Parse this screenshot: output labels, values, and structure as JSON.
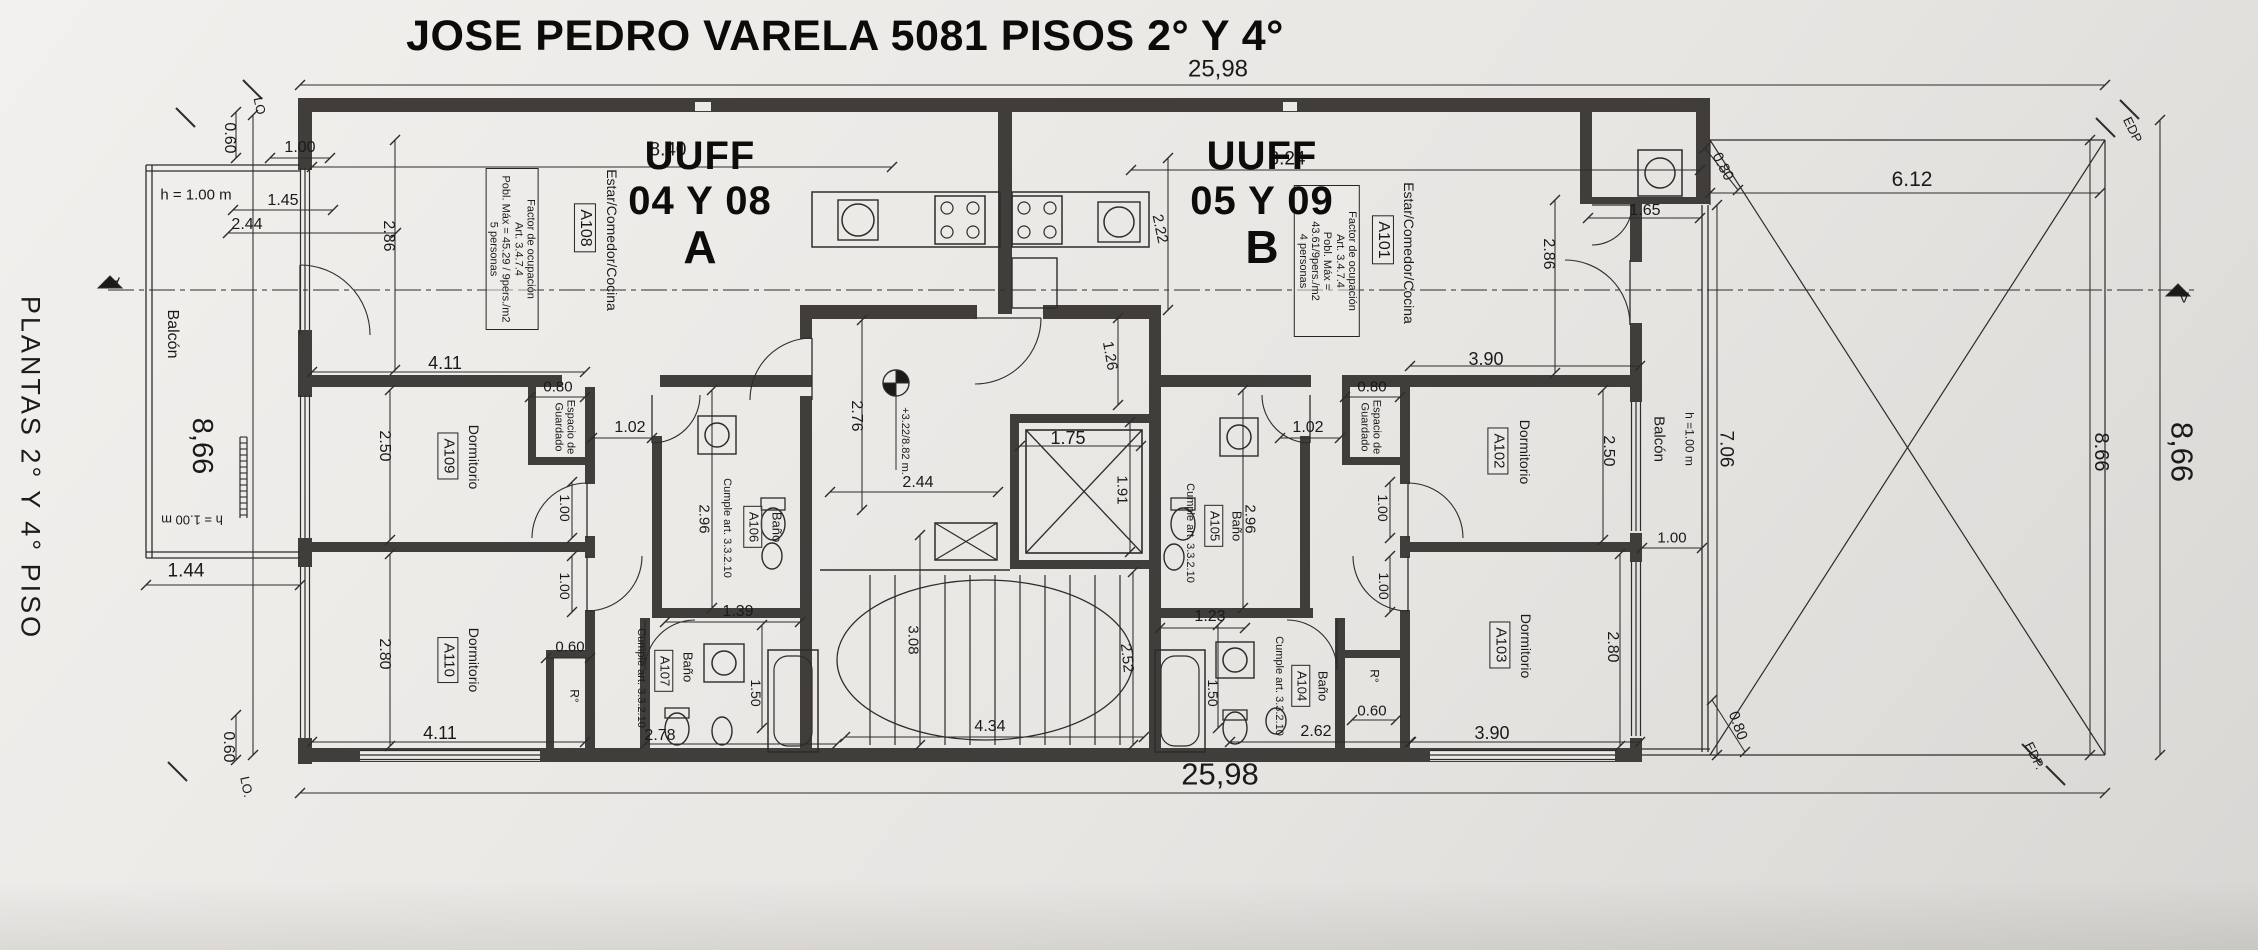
{
  "header": {
    "title": "JOSE PEDRO VARELA 5081 PISOS 2° Y 4°"
  },
  "side_label": "PLANTAS 2° Y 4° PISO",
  "units": {
    "a": {
      "uuff": "UUFF",
      "numbers": "04 Y 08",
      "letter": "A"
    },
    "b": {
      "uuff": "UUFF",
      "numbers": "05 Y 09",
      "letter": "B"
    }
  },
  "colors": {
    "paper": "#eceae7",
    "ink": "#2e2c2a",
    "wall": "#403d3b"
  },
  "labels": [
    {
      "name": "dim-frente-top",
      "text": "25,98",
      "x": 1218,
      "y": 70,
      "size": 24
    },
    {
      "name": "dim-frente-bottom",
      "text": "25,98",
      "x": 1220,
      "y": 775,
      "size": 31
    },
    {
      "name": "dim-patio-frente",
      "text": "6.12",
      "x": 1912,
      "y": 180,
      "size": 21
    },
    {
      "name": "dim-patio-lateral",
      "text": "8.66",
      "x": 2101,
      "y": 452,
      "rot": 90,
      "size": 20
    },
    {
      "name": "dim-lateral-right",
      "text": "8,66",
      "x": 2181,
      "y": 452,
      "rot": 90,
      "size": 31
    },
    {
      "name": "dim-lateral-left",
      "text": "8,66",
      "x": 202,
      "y": 446,
      "rot": 90,
      "size": 29
    },
    {
      "name": "edp-marker-top",
      "text": "EDP",
      "x": 2132,
      "y": 130,
      "rot": 64,
      "size": 13
    },
    {
      "name": "edp-marker-bottom",
      "text": "EDP.",
      "x": 2034,
      "y": 756,
      "rot": 64,
      "size": 13
    },
    {
      "name": "lot-marker-top",
      "text": "LO",
      "x": 259,
      "y": 106,
      "rot": 78,
      "size": 13
    },
    {
      "name": "lot-marker-bottom",
      "text": "LO.",
      "x": 246,
      "y": 787,
      "rot": 78,
      "size": 13
    },
    {
      "name": "balcony-a-label",
      "text": "Balcón",
      "x": 172,
      "y": 334,
      "rot": 90,
      "size": 16
    },
    {
      "name": "balcony-a-h-top",
      "text": "h = 1.00 m",
      "x": 196,
      "y": 196,
      "size": 15
    },
    {
      "name": "balcony-a-h-bottom",
      "text": "h = 1.00 m",
      "x": 192,
      "y": 519,
      "rot": 180,
      "size": 13
    },
    {
      "name": "dim-balcony-a",
      "text": "1.44",
      "x": 186,
      "y": 571,
      "size": 19
    },
    {
      "name": "dim-setback-top-left",
      "text": "0.60",
      "x": 229,
      "y": 138,
      "rot": 90,
      "size": 16
    },
    {
      "name": "dim-setback-bottom-left",
      "text": "0.60",
      "x": 228,
      "y": 747,
      "rot": 90,
      "size": 16
    },
    {
      "name": "dim-estar-a-win1",
      "text": "1.00",
      "x": 300,
      "y": 148,
      "size": 16
    },
    {
      "name": "dim-estar-a-win2",
      "text": "1.45",
      "x": 283,
      "y": 201,
      "size": 16
    },
    {
      "name": "dim-estar-a-win3",
      "text": "2.44",
      "x": 247,
      "y": 225,
      "size": 16
    },
    {
      "name": "dim-estar-a-depth",
      "text": "2.86",
      "x": 388,
      "y": 236,
      "rot": 90,
      "size": 16
    },
    {
      "name": "dim-estar-a-width",
      "text": "8.40",
      "x": 668,
      "y": 150,
      "size": 19
    },
    {
      "name": "estar-a-label",
      "text": "Estar/Comedor/Cocina",
      "x": 611,
      "y": 240,
      "rot": 90,
      "size": 14
    },
    {
      "name": "estar-a-tag",
      "text": "A108",
      "x": 585,
      "y": 228,
      "rot": 90,
      "size": 16,
      "boxed": true
    },
    {
      "name": "occupancy-note-a",
      "text": "Factor de ocupación\nArt. 3.4.7.4\nPobl. Máx = 45.29 / 9pers./m2\n5 personas",
      "x": 512,
      "y": 249,
      "rot": 90,
      "size": 11,
      "boxed": true,
      "w": 150
    },
    {
      "name": "dim-a109-width",
      "text": "4.11",
      "x": 445,
      "y": 363,
      "size": 18
    },
    {
      "name": "dim-a109-depth",
      "text": "2.50",
      "x": 384,
      "y": 446,
      "rot": 90,
      "size": 16
    },
    {
      "name": "a109-label",
      "text": "Dormitorio",
      "x": 473,
      "y": 457,
      "rot": 90,
      "size": 14
    },
    {
      "name": "a109-tag",
      "text": "A109",
      "x": 448,
      "y": 456,
      "rot": 90,
      "size": 15,
      "boxed": true
    },
    {
      "name": "dim-closet-a",
      "text": "0.80",
      "x": 558,
      "y": 388,
      "size": 15
    },
    {
      "name": "closet-a-label",
      "text": "Espacio de\nGuardado",
      "x": 564,
      "y": 427,
      "rot": 90,
      "size": 11
    },
    {
      "name": "dim-pasillo-a",
      "text": "1.02",
      "x": 630,
      "y": 428,
      "size": 16
    },
    {
      "name": "dim-door-a109",
      "text": "1.00",
      "x": 564,
      "y": 508,
      "rot": 90,
      "size": 14
    },
    {
      "name": "dim-door-a110",
      "text": "1.00",
      "x": 564,
      "y": 586,
      "rot": 90,
      "size": 14
    },
    {
      "name": "dim-bano-a106-depth",
      "text": "2.96",
      "x": 703,
      "y": 519,
      "rot": 90,
      "size": 15
    },
    {
      "name": "bano-a106-note",
      "text": "Cumple art. 3.3.2.10",
      "x": 727,
      "y": 528,
      "rot": 90,
      "size": 11
    },
    {
      "name": "bano-a106-tag",
      "text": "A106",
      "x": 753,
      "y": 527,
      "rot": 90,
      "size": 13,
      "boxed": true
    },
    {
      "name": "bano-a106-label",
      "text": "Baño",
      "x": 776,
      "y": 527,
      "rot": 90,
      "size": 13
    },
    {
      "name": "dim-bano-a106-width",
      "text": "1.39",
      "x": 738,
      "y": 612,
      "size": 16
    },
    {
      "name": "dim-ropero-a",
      "text": "0.60",
      "x": 570,
      "y": 648,
      "size": 15
    },
    {
      "name": "ropero-a-label",
      "text": "R°",
      "x": 574,
      "y": 696,
      "rot": 90,
      "size": 12
    },
    {
      "name": "a110-label",
      "text": "Dormitorio",
      "x": 473,
      "y": 660,
      "rot": 90,
      "size": 14
    },
    {
      "name": "a110-tag",
      "text": "A110",
      "x": 448,
      "y": 660,
      "rot": 90,
      "size": 15,
      "boxed": true
    },
    {
      "name": "dim-a110-depth",
      "text": "2.80",
      "x": 384,
      "y": 654,
      "rot": 90,
      "size": 16
    },
    {
      "name": "dim-a110-width",
      "text": "4.11",
      "x": 440,
      "y": 733,
      "size": 18
    },
    {
      "name": "bano-a107-note",
      "text": "Cumple art. 3.3.2.10",
      "x": 641,
      "y": 678,
      "rot": 90,
      "size": 11
    },
    {
      "name": "bano-a107-tag",
      "text": "A107",
      "x": 664,
      "y": 671,
      "rot": 90,
      "size": 13,
      "boxed": true
    },
    {
      "name": "bano-a107-label",
      "text": "Baño",
      "x": 687,
      "y": 667,
      "rot": 90,
      "size": 13
    },
    {
      "name": "dim-bano-a107-width",
      "text": "2.78",
      "x": 660,
      "y": 736,
      "size": 16
    },
    {
      "name": "dim-bano-a107-depth",
      "text": "1.50",
      "x": 755,
      "y": 693,
      "rot": 90,
      "size": 14
    },
    {
      "name": "dim-hall-depth",
      "text": "2.76",
      "x": 856,
      "y": 416,
      "rot": 90,
      "size": 16
    },
    {
      "name": "elevation-note",
      "text": "+3.22/8.82 m.",
      "x": 905,
      "y": 441,
      "rot": 90,
      "size": 11
    },
    {
      "name": "dim-hall-width",
      "text": "2.44",
      "x": 918,
      "y": 483,
      "size": 16
    },
    {
      "name": "dim-elevator-width",
      "text": "1.75",
      "x": 1068,
      "y": 438,
      "size": 18
    },
    {
      "name": "dim-elevator-depth",
      "text": "1.91",
      "x": 1121,
      "y": 490,
      "rot": 90,
      "size": 15
    },
    {
      "name": "dim-hall-front",
      "text": "1.26",
      "x": 1109,
      "y": 356,
      "rot": 80,
      "size": 15
    },
    {
      "name": "dim-cocina-b",
      "text": "2.22",
      "x": 1159,
      "y": 229,
      "rot": 78,
      "size": 15
    },
    {
      "name": "dim-stairs-width",
      "text": "3.08",
      "x": 912,
      "y": 640,
      "rot": 90,
      "size": 15
    },
    {
      "name": "dim-stairs-run",
      "text": "2.52",
      "x": 1126,
      "y": 658,
      "rot": 84,
      "size": 15
    },
    {
      "name": "dim-stairs-length",
      "text": "4.34",
      "x": 990,
      "y": 727,
      "size": 16
    },
    {
      "name": "dim-estar-b-width",
      "text": "8.24",
      "x": 1287,
      "y": 159,
      "size": 19
    },
    {
      "name": "estar-b-label",
      "text": "Estar/Comedor/Cocina",
      "x": 1408,
      "y": 253,
      "rot": 90,
      "size": 14
    },
    {
      "name": "estar-b-tag",
      "text": "A101",
      "x": 1383,
      "y": 240,
      "rot": 90,
      "size": 16,
      "boxed": true
    },
    {
      "name": "occupancy-note-b",
      "text": "Factor de ocupación\nArt. 3.4.7.4\nPobl. Máx = 43.61/9pers./m2\n4 personas",
      "x": 1327,
      "y": 261,
      "rot": 90,
      "size": 11,
      "boxed": true,
      "w": 140
    },
    {
      "name": "dim-lavadero",
      "text": "1.65",
      "x": 1645,
      "y": 211,
      "size": 16
    },
    {
      "name": "dim-estar-b-depth",
      "text": "2.86",
      "x": 1548,
      "y": 254,
      "rot": 90,
      "size": 16
    },
    {
      "name": "dim-closet-b",
      "text": "0.80",
      "x": 1372,
      "y": 388,
      "size": 15
    },
    {
      "name": "closet-b-label",
      "text": "Espacio de\nGuardado",
      "x": 1370,
      "y": 427,
      "rot": 90,
      "size": 11
    },
    {
      "name": "dim-pasillo-b",
      "text": "1.02",
      "x": 1308,
      "y": 428,
      "size": 16
    },
    {
      "name": "dim-bano-a105-depth",
      "text": "2.96",
      "x": 1249,
      "y": 519,
      "rot": 90,
      "size": 15
    },
    {
      "name": "bano-a105-note",
      "text": "Cumple art. 3.3.2.10",
      "x": 1190,
      "y": 533,
      "rot": 90,
      "size": 11
    },
    {
      "name": "bano-a105-tag",
      "text": "A105",
      "x": 1214,
      "y": 526,
      "rot": 90,
      "size": 13,
      "boxed": true
    },
    {
      "name": "bano-a105-label",
      "text": "Baño",
      "x": 1236,
      "y": 526,
      "rot": 90,
      "size": 13
    },
    {
      "name": "dim-bano-a105-width",
      "text": "1.23",
      "x": 1210,
      "y": 617,
      "size": 16
    },
    {
      "name": "dim-door-a102",
      "text": "1.00",
      "x": 1382,
      "y": 508,
      "rot": 90,
      "size": 14
    },
    {
      "name": "dim-door-a103",
      "text": "1.00",
      "x": 1383,
      "y": 586,
      "rot": 90,
      "size": 14
    },
    {
      "name": "dim-a102-width",
      "text": "3.90",
      "x": 1486,
      "y": 359,
      "size": 18
    },
    {
      "name": "a102-label",
      "text": "Dormitorio",
      "x": 1524,
      "y": 452,
      "rot": 90,
      "size": 14
    },
    {
      "name": "a102-tag",
      "text": "A102",
      "x": 1498,
      "y": 451,
      "rot": 90,
      "size": 15,
      "boxed": true
    },
    {
      "name": "dim-a102-depth",
      "text": "2.50",
      "x": 1608,
      "y": 451,
      "rot": 90,
      "size": 16
    },
    {
      "name": "a103-label",
      "text": "Dormitorio",
      "x": 1525,
      "y": 646,
      "rot": 90,
      "size": 14
    },
    {
      "name": "a103-tag",
      "text": "A103",
      "x": 1500,
      "y": 645,
      "rot": 90,
      "size": 15,
      "boxed": true
    },
    {
      "name": "dim-a103-depth",
      "text": "2.80",
      "x": 1612,
      "y": 647,
      "rot": 90,
      "size": 16
    },
    {
      "name": "dim-a103-width",
      "text": "3.90",
      "x": 1492,
      "y": 733,
      "size": 18
    },
    {
      "name": "bano-a104-note",
      "text": "Cumple art. 3.3.2.10",
      "x": 1279,
      "y": 686,
      "rot": 90,
      "size": 11
    },
    {
      "name": "bano-a104-tag",
      "text": "A104",
      "x": 1301,
      "y": 686,
      "rot": 90,
      "size": 13,
      "boxed": true
    },
    {
      "name": "bano-a104-label",
      "text": "Baño",
      "x": 1322,
      "y": 686,
      "rot": 90,
      "size": 13
    },
    {
      "name": "dim-bano-a104-width",
      "text": "2.62",
      "x": 1316,
      "y": 732,
      "size": 16
    },
    {
      "name": "dim-bano-a104-depth",
      "text": "1.50",
      "x": 1212,
      "y": 693,
      "rot": 90,
      "size": 14
    },
    {
      "name": "ropero-b-label",
      "text": "R°",
      "x": 1374,
      "y": 676,
      "rot": 90,
      "size": 12
    },
    {
      "name": "dim-ropero-b",
      "text": "0.60",
      "x": 1372,
      "y": 712,
      "size": 15
    },
    {
      "name": "balcony-b-label",
      "text": "Balcón",
      "x": 1658,
      "y": 439,
      "rot": 90,
      "size": 15
    },
    {
      "name": "balcony-b-h",
      "text": "h =1.00 m",
      "x": 1689,
      "y": 439,
      "rot": 90,
      "size": 12
    },
    {
      "name": "dim-balcony-b-depth",
      "text": "7.06",
      "x": 1726,
      "y": 449,
      "rot": 90,
      "size": 19
    },
    {
      "name": "dim-balcony-b-div",
      "text": "1.00",
      "x": 1672,
      "y": 539,
      "size": 15
    },
    {
      "name": "dim-corner-tr",
      "text": "0.80",
      "x": 1722,
      "y": 167,
      "rot": 62,
      "size": 15
    },
    {
      "name": "dim-corner-br",
      "text": "0.80",
      "x": 1737,
      "y": 726,
      "rot": 70,
      "size": 15
    },
    {
      "name": "section-mark-left",
      "text": "A",
      "x": 115,
      "y": 281,
      "rot": 180,
      "size": 15
    },
    {
      "name": "section-mark-right",
      "text": "A",
      "x": 2184,
      "y": 296,
      "rot": 180,
      "size": 15
    }
  ]
}
